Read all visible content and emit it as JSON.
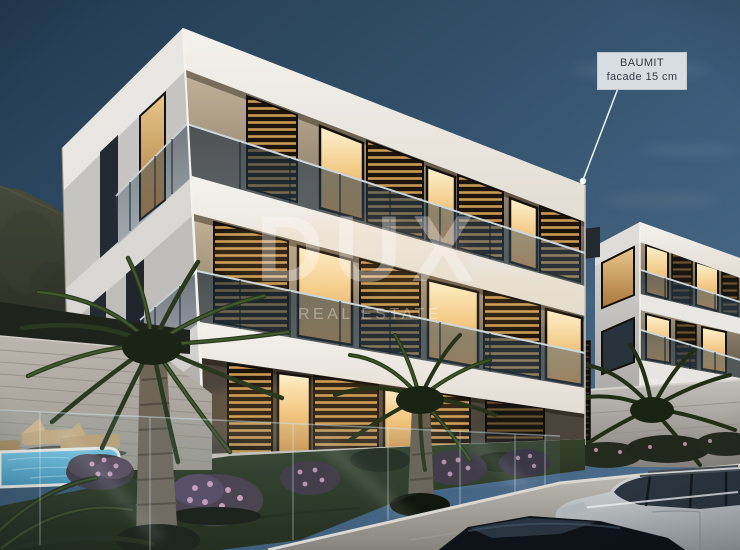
{
  "watermark": {
    "brand": "DUX",
    "tagline": "REAL ESTATE"
  },
  "annotation": {
    "title": "BAUMIT",
    "detail": "facade 15 cm"
  },
  "palette": {
    "sky_top": "#243c52",
    "sky_bottom": "#527394",
    "facade_white": "#eceae6",
    "window_glow": "#f3cc8a",
    "shutter_dark": "#1d150c",
    "lawn_green": "#2c3a22",
    "pool_blue": "#63b6da",
    "label_background": "#d8dde2",
    "watermark_white": "#ffffff"
  }
}
